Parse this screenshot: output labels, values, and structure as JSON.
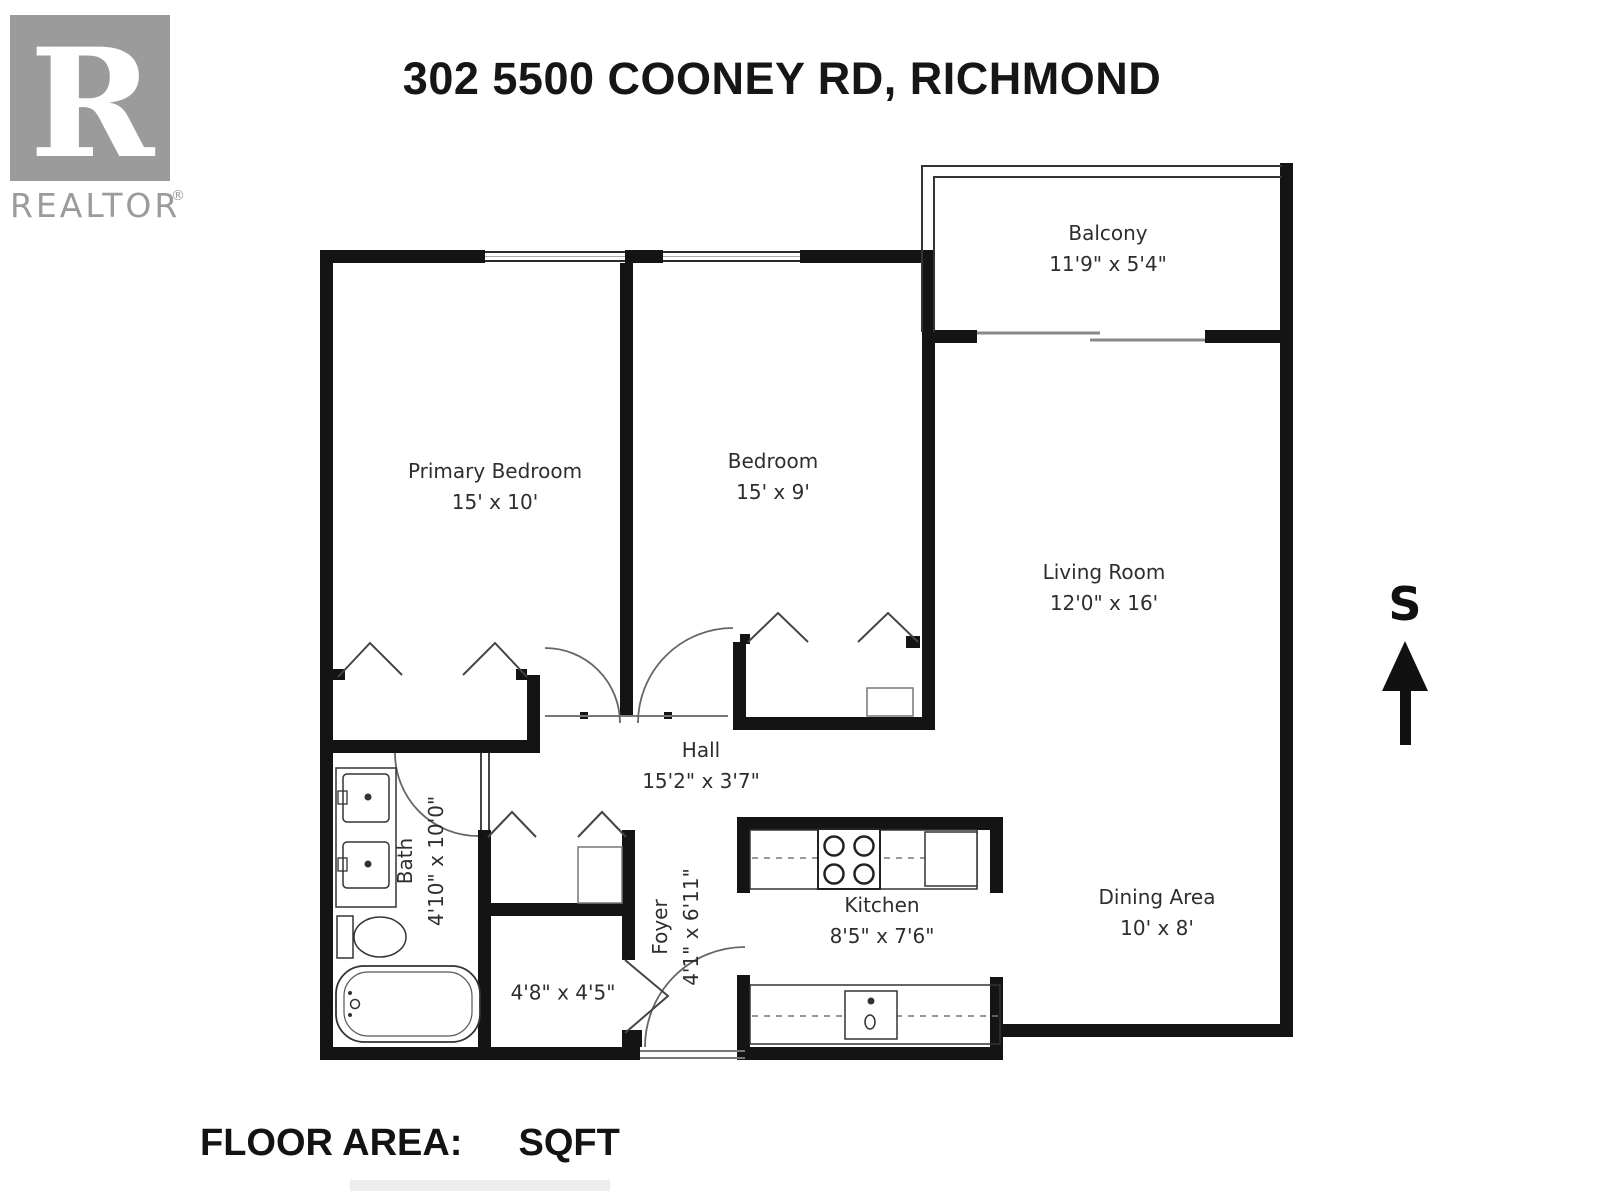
{
  "title": "302 5500 COONEY RD, RICHMOND",
  "logo": {
    "r": "R",
    "wordmark": "REALTOR",
    "registered": "®"
  },
  "compass": {
    "label": "S"
  },
  "rooms": {
    "balcony": {
      "name": "Balcony",
      "dims": "11'9\" x 5'4\""
    },
    "primary_bedroom": {
      "name": "Primary Bedroom",
      "dims": "15' x 10'"
    },
    "bedroom": {
      "name": "Bedroom",
      "dims": "15' x 9'"
    },
    "living_room": {
      "name": "Living Room",
      "dims": "12'0\" x 16'"
    },
    "hall": {
      "name": "Hall",
      "dims": "15'2\" x 3'7\""
    },
    "bath": {
      "name": "Bath",
      "dims": "4'10\" x 10'0\""
    },
    "closet": {
      "name": "",
      "dims": "4'8\" x 4'5\""
    },
    "foyer": {
      "name": "Foyer",
      "dims": "4'1\" x 6'11\""
    },
    "kitchen": {
      "name": "Kitchen",
      "dims": "8'5\" x 7'6\""
    },
    "dining": {
      "name": "Dining Area",
      "dims": "10' x 8'"
    }
  },
  "footer": {
    "label": "FLOOR AREA:",
    "value": "SQFT"
  },
  "colors": {
    "wall": "#141414",
    "thin_line": "#333333",
    "label_text": "#2e2e2e",
    "logo_gray": "#9b9b9b"
  }
}
